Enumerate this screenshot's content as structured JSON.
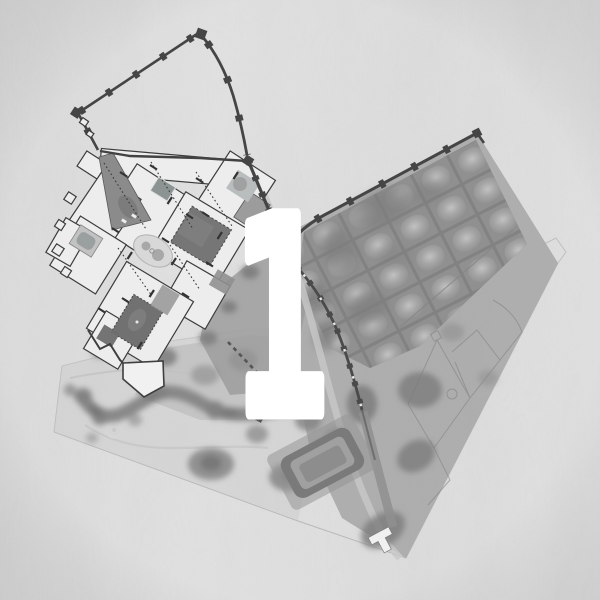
{
  "figure": {
    "label": "1"
  },
  "colors": {
    "paper": "#dfdfdf",
    "wash": "#cbcbcb",
    "terrain": "#ababab",
    "orchard": "#8f8f8f",
    "canopy": "#7e7e7e",
    "wall": "#454545",
    "palace": "#ededed",
    "court": "#767676",
    "pathlight": "#c8c8c8",
    "numeral": "#ffffff"
  }
}
